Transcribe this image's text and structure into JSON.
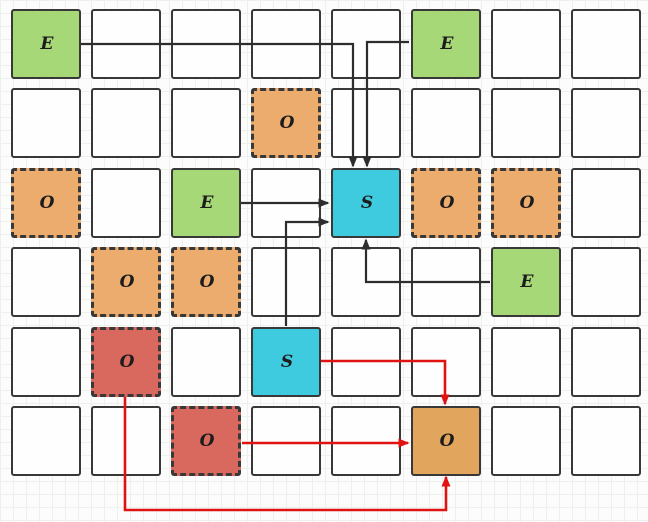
{
  "diagram": {
    "name": "grid-path-diagram",
    "grid": {
      "rows": 6,
      "cols": 8,
      "cell_size": 70,
      "col_x": [
        11,
        91,
        171,
        251,
        331,
        411,
        491,
        571
      ],
      "row_y": [
        9,
        88,
        168,
        247,
        327,
        406
      ]
    },
    "cell_types": {
      "green-solid": {
        "fill": "#a7d877",
        "border_style": "solid"
      },
      "cyan-solid": {
        "fill": "#3fcbdf",
        "border_style": "solid"
      },
      "orange-dashed": {
        "fill": "#ebac6e",
        "border_style": "dashed"
      },
      "red-dashed": {
        "fill": "#d9695e",
        "border_style": "dashed"
      },
      "orange-solid": {
        "fill": "#e2a55d",
        "border_style": "solid"
      },
      "empty": {
        "fill": "#fefefe",
        "border_style": "solid"
      }
    },
    "labeled_cells": [
      {
        "row": 0,
        "col": 0,
        "label": "E",
        "type": "green-solid"
      },
      {
        "row": 0,
        "col": 5,
        "label": "E",
        "type": "green-solid"
      },
      {
        "row": 1,
        "col": 3,
        "label": "O",
        "type": "orange-dashed"
      },
      {
        "row": 2,
        "col": 0,
        "label": "O",
        "type": "orange-dashed"
      },
      {
        "row": 2,
        "col": 2,
        "label": "E",
        "type": "green-solid"
      },
      {
        "row": 2,
        "col": 4,
        "label": "S",
        "type": "cyan-solid"
      },
      {
        "row": 2,
        "col": 5,
        "label": "O",
        "type": "orange-dashed"
      },
      {
        "row": 2,
        "col": 6,
        "label": "O",
        "type": "orange-dashed"
      },
      {
        "row": 3,
        "col": 1,
        "label": "O",
        "type": "orange-dashed"
      },
      {
        "row": 3,
        "col": 2,
        "label": "O",
        "type": "orange-dashed"
      },
      {
        "row": 3,
        "col": 6,
        "label": "E",
        "type": "green-solid"
      },
      {
        "row": 4,
        "col": 1,
        "label": "O",
        "type": "red-dashed"
      },
      {
        "row": 4,
        "col": 3,
        "label": "S",
        "type": "cyan-solid"
      },
      {
        "row": 5,
        "col": 2,
        "label": "O",
        "type": "red-dashed"
      },
      {
        "row": 5,
        "col": 5,
        "label": "O",
        "type": "orange-solid"
      }
    ],
    "arrow_styles": {
      "black": {
        "stroke": "#2d2d2d",
        "width": 2.2
      },
      "red": {
        "stroke": "#e01212",
        "width": 2.6
      }
    },
    "arrows": [
      {
        "id": "e11-to-s35",
        "color": "black",
        "points": [
          [
            81,
            44
          ],
          [
            353,
            44
          ],
          [
            353,
            166
          ]
        ]
      },
      {
        "id": "e16-to-s35",
        "color": "black",
        "points": [
          [
            409,
            42
          ],
          [
            367,
            42
          ],
          [
            367,
            166
          ]
        ]
      },
      {
        "id": "e33-to-s35",
        "color": "black",
        "points": [
          [
            241,
            203
          ],
          [
            328,
            203
          ]
        ]
      },
      {
        "id": "s54-to-s35",
        "color": "black",
        "points": [
          [
            286,
            326
          ],
          [
            286,
            222
          ],
          [
            328,
            222
          ]
        ]
      },
      {
        "id": "e47-to-s35",
        "color": "black",
        "points": [
          [
            490,
            282
          ],
          [
            366,
            282
          ],
          [
            366,
            240
          ]
        ]
      },
      {
        "id": "s54-to-o66",
        "color": "red",
        "points": [
          [
            321,
            361
          ],
          [
            445,
            361
          ],
          [
            445,
            404
          ]
        ]
      },
      {
        "id": "o63-to-o66",
        "color": "red",
        "points": [
          [
            242,
            443
          ],
          [
            408,
            443
          ]
        ]
      },
      {
        "id": "o52-to-o66",
        "color": "red",
        "points": [
          [
            125,
            397
          ],
          [
            125,
            510
          ],
          [
            446,
            510
          ],
          [
            446,
            477
          ]
        ]
      }
    ],
    "background": {
      "paper": "#fbfcfb",
      "grid_line": "#edf0ec",
      "cell_border": "#383838",
      "label_color": "#1c1c1c"
    }
  }
}
